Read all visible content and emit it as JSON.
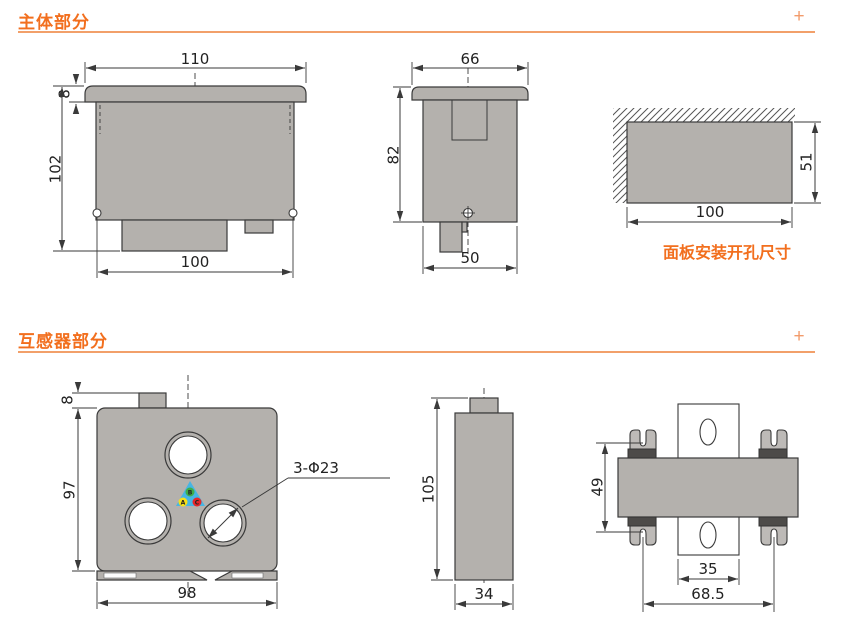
{
  "colors": {
    "accent_orange": "#f26f1e",
    "divider_orange": "#f2a06a",
    "plus_orange": "#f29b6b",
    "drawing_gray": "#b4b1ad",
    "line_dark": "#3a3a3a"
  },
  "sections": {
    "main": {
      "title": "主体部分",
      "expand": "+"
    },
    "ct": {
      "title": "互感器部分",
      "expand": "+"
    }
  },
  "main_front": {
    "top_width": "110",
    "flange_height": "8",
    "total_height": "102",
    "body_width": "100"
  },
  "main_side": {
    "top_width": "66",
    "height": "82",
    "bottom_width": "50"
  },
  "panel_cutout": {
    "width": "100",
    "height": "51",
    "caption": "面板安装开孔尺寸"
  },
  "ct_front": {
    "tab_height": "8",
    "height": "97",
    "width": "98",
    "holes_label": "3-Φ23",
    "triangle_color": "#47b5e3",
    "phases": [
      {
        "label": "A",
        "color": "#f6e019"
      },
      {
        "label": "B",
        "color": "#3fae49"
      },
      {
        "label": "C",
        "color": "#e62629"
      }
    ]
  },
  "ct_side": {
    "height": "105",
    "width": "34"
  },
  "ct_top": {
    "clip_height": "49",
    "rail_width": "35",
    "clip_span": "68.5"
  }
}
